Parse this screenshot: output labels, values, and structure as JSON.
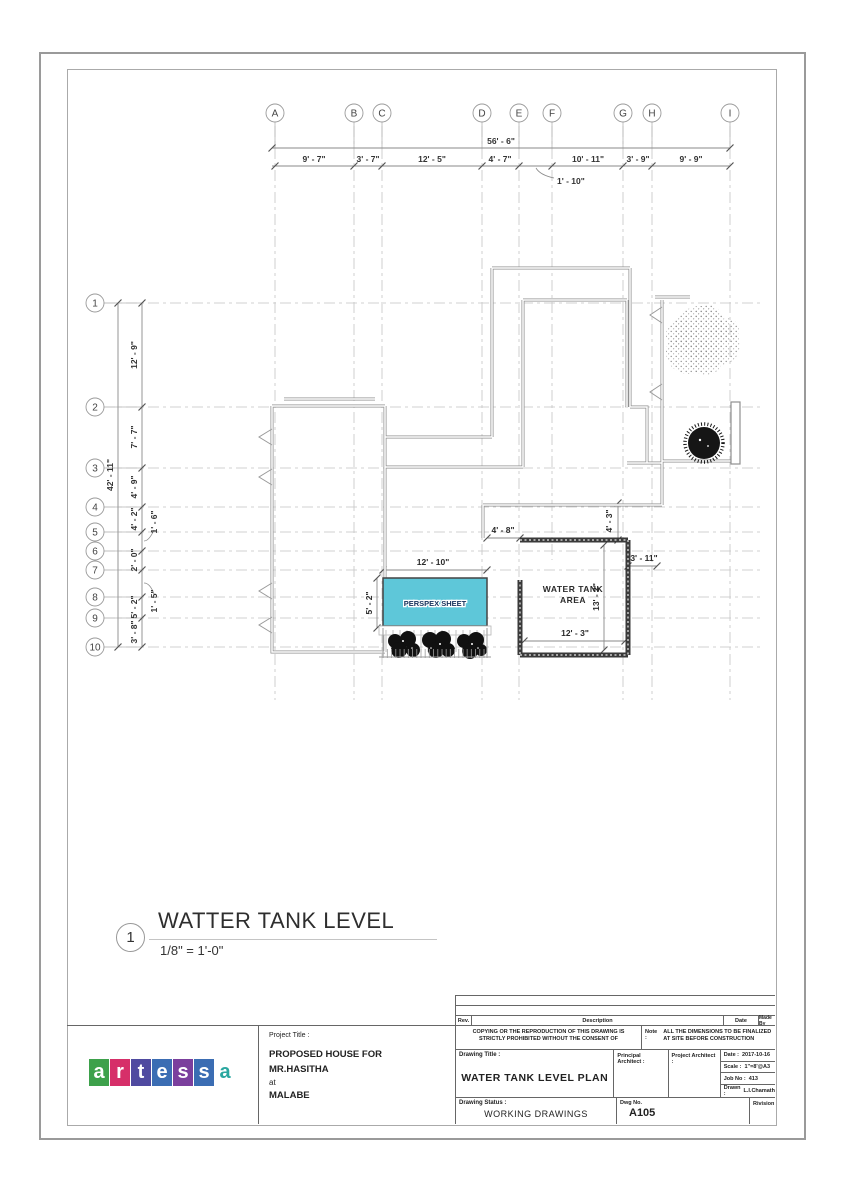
{
  "sheet": {
    "view_number": "1",
    "view_title": "WATTER TANK LEVEL",
    "view_scale": "1/8\" = 1'-0\""
  },
  "grid": {
    "cols": [
      "A",
      "B",
      "C",
      "D",
      "E",
      "F",
      "G",
      "H",
      "I"
    ],
    "rows": [
      "1",
      "2",
      "3",
      "4",
      "5",
      "6",
      "7",
      "8",
      "9",
      "10"
    ]
  },
  "dims_top": {
    "overall": "56' - 6\"",
    "seg_ab": "9' - 7\"",
    "seg_bc": "3' - 7\"",
    "seg_cd": "12' - 5\"",
    "seg_de": "4' - 7\"",
    "seg_ef": "1' - 10\"",
    "seg_fg": "10' - 11\"",
    "seg_gh": "3' - 9\"",
    "seg_hi": "9' - 9\""
  },
  "dims_left": {
    "overall": "42' - 11\"",
    "seg_12": "12' - 9\"",
    "seg_23": "7' - 7\"",
    "seg_34": "4' - 9\"",
    "seg_45": "4' - 2\"",
    "seg_56": "1' - 6\"",
    "seg_67": "2' - 0\"",
    "seg_78": "1' - 5\"",
    "seg_89": "5' - 2\"",
    "seg_910": "3' - 8\""
  },
  "plan": {
    "perspex_label": "PERSPEX SHEET",
    "perspex_fill": "#5ec7d9",
    "water_tank_line1": "WATER TANK",
    "water_tank_line2": "AREA",
    "dim_perspex_w": "12' - 10\"",
    "dim_perspex_h": "5' - 2\"",
    "dim_gap": "4' - 8\"",
    "dim_tank_top": "4' - 3\"",
    "dim_tank_right": "3' - 11\"",
    "dim_tank_h": "13' - 2\"",
    "dim_tank_w": "12' - 3\""
  },
  "title_block": {
    "rev": "Rev.",
    "description": "Description",
    "date_col": "Date",
    "made_by": "Made By",
    "copyright": "COPYING OR THE REPRODUCTION OF THIS DRAWING IS STRICTLY PROHIBITED WITHOUT THE CONSENT OF",
    "note_label": "Note :",
    "note": "ALL THE DIMENSIONS TO BE FINALIZED AT SITE BEFORE CONSTRUCTION",
    "drawing_title_label": "Drawing Title :",
    "drawing_title": "WATER TANK LEVEL PLAN",
    "principal_architect_label": "Principal Architect :",
    "project_architect_label": "Project Architect :",
    "date_label": "Date :",
    "date": "2017-10-16",
    "scale_label": "Scale :",
    "scale": "1\"=8'@A3",
    "job_label": "Job No :",
    "job": "413",
    "drawn_label": "Drawn :",
    "drawn": "L.I.Chamath",
    "status_label": "Drawing Status :",
    "status": "WORKING DRAWINGS",
    "dwg_label": "Dwg No.",
    "dwg_no": "A105",
    "revision_label": "Rivision",
    "project_title_label": "Project Title :",
    "project_line1": "PROPOSED HOUSE FOR",
    "project_line2": "MR.HASITHA",
    "project_line3": "at",
    "project_line4": "MALABE"
  },
  "logo": {
    "letters": [
      {
        "char": "a",
        "bg": "#3da14b",
        "fg": "#ffffff"
      },
      {
        "char": "r",
        "bg": "#d62f69",
        "fg": "#ffffff"
      },
      {
        "char": "t",
        "bg": "#4f4aa0",
        "fg": "#ffffff"
      },
      {
        "char": "e",
        "bg": "#3b6db3",
        "fg": "#ffffff"
      },
      {
        "char": "s",
        "bg": "#7b3f9d",
        "fg": "#ffffff"
      },
      {
        "char": "s",
        "bg": "#3b6db3",
        "fg": "#ffffff"
      },
      {
        "char": "a",
        "bg": "#ffffff",
        "fg": "#2aa7a0"
      }
    ]
  }
}
